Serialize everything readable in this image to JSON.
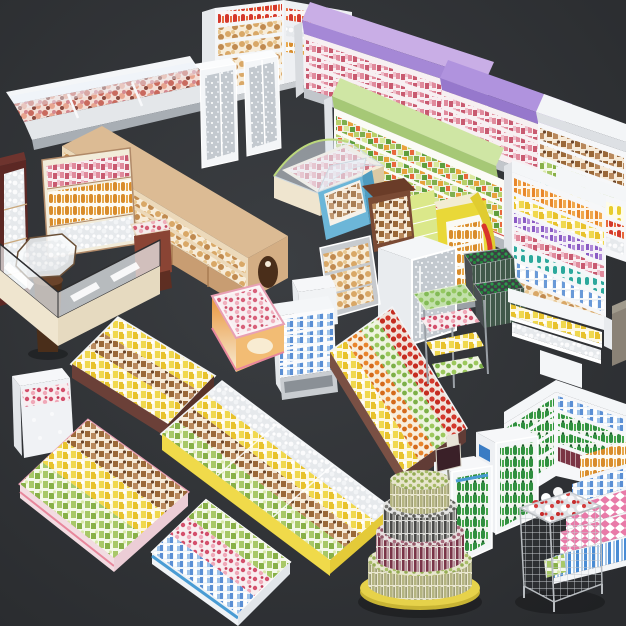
{
  "scene": {
    "title": "3D supermarket equipment set render",
    "background": {
      "floor_center": "#3b3e42",
      "floor_edge": "#2a2c2f"
    },
    "palette": {
      "lavender_canopy": "#c9aee6",
      "lavender_deep": "#a588d6",
      "purple_canopy": "#b093de",
      "purple_deep": "#9678cc",
      "green_canopy": "#cfe6a4",
      "green_deep": "#a6c876",
      "lime_shelf": "#dbe88a",
      "wood_light": "#dcbb94",
      "wood_mid": "#c89d72",
      "wood_dark": "#4a2e1a",
      "burgundy": "#5c2824",
      "cream_counter": "#efe5cf",
      "blue_case": "#6cb6d8",
      "cooler_yellow": "#e9d838",
      "freezer_yellow_band": "#f0da4a",
      "pink_trim": "#e8a0b4",
      "blue_trim": "#4a9cd4",
      "bronze_island": "#7a5044",
      "brown_freezer": "#6b4038",
      "can_base_yellow": "#e6d24a",
      "fixture_white": "#f4f6f8"
    },
    "fixtures": [
      {
        "id": "deli-counter",
        "label": "refrigerated serve-over deli counter"
      },
      {
        "id": "corner-gondola",
        "label": "white corner gondola with bakery and bottles"
      },
      {
        "id": "display-cabinets",
        "label": "tall glass display cabinets"
      },
      {
        "id": "multideck-lavender",
        "label": "lavender-top multideck chiller"
      },
      {
        "id": "multideck-purple",
        "label": "purple-top multideck chiller"
      },
      {
        "id": "multideck-white",
        "label": "white-top multideck chiller"
      },
      {
        "id": "produce-multideck",
        "label": "green-top produce multideck"
      },
      {
        "id": "bottle-shelf-right",
        "label": "soda bottle shelf"
      },
      {
        "id": "dairy-gondola",
        "label": "dairy and juice gondola"
      },
      {
        "id": "bread-gondola",
        "label": "wooden bakery gondola"
      },
      {
        "id": "baguette-rack",
        "label": "baguette rack"
      },
      {
        "id": "burgundy-cabinet",
        "label": "burgundy display cabinet"
      },
      {
        "id": "pastry-case",
        "label": "curved glass pastry case"
      },
      {
        "id": "pastry-case-blue",
        "label": "blue curved pastry case"
      },
      {
        "id": "confection-stand",
        "label": "confectionery stand with lime shelves"
      },
      {
        "id": "octagon-display",
        "label": "octagonal glass display on pedestal"
      },
      {
        "id": "sweet-stand",
        "label": "small wooden sweets stand"
      },
      {
        "id": "serveover-counter",
        "label": "L-shaped glass service counter"
      },
      {
        "id": "yellow-cooler",
        "label": "yellow impulse drinks cooler"
      },
      {
        "id": "beer-crates",
        "label": "stacked bottle crates"
      },
      {
        "id": "produce-rack",
        "label": "greens and fruit rack"
      },
      {
        "id": "snack-shelf",
        "label": "low snack shelf"
      },
      {
        "id": "produce-island",
        "label": "bronze produce island"
      },
      {
        "id": "dairy-cooler-mini",
        "label": "mini open-front dairy cooler"
      },
      {
        "id": "icecream-freezer",
        "label": "pink ice-cream chest freezer"
      },
      {
        "id": "acrylic-shelf",
        "label": "acrylic donut shelf"
      },
      {
        "id": "white-counter-cube",
        "label": "white counter cube"
      },
      {
        "id": "glassdoor-fridge",
        "label": "tall glass-door fridge"
      },
      {
        "id": "brown-freezer",
        "label": "brown island chest freezer"
      },
      {
        "id": "upright-freezer",
        "label": "small white upright freezer"
      },
      {
        "id": "island-freezer-yellow",
        "label": "long yellow island freezer"
      },
      {
        "id": "chest-freezer-pink",
        "label": "pink chest freezer"
      },
      {
        "id": "chest-freezer-blue",
        "label": "blue chest freezer"
      },
      {
        "id": "bottle-gondola-green",
        "label": "green bottle gondola corner"
      },
      {
        "id": "side-box",
        "label": "edge cabinet fragment"
      },
      {
        "id": "bottle-coolers",
        "label": "glass-door bottle coolers"
      },
      {
        "id": "can-tower",
        "label": "tiered round can display tower"
      },
      {
        "id": "candy-steps",
        "label": "stepped candy display"
      },
      {
        "id": "wire-basket",
        "label": "wire mesh dump basket"
      }
    ]
  }
}
